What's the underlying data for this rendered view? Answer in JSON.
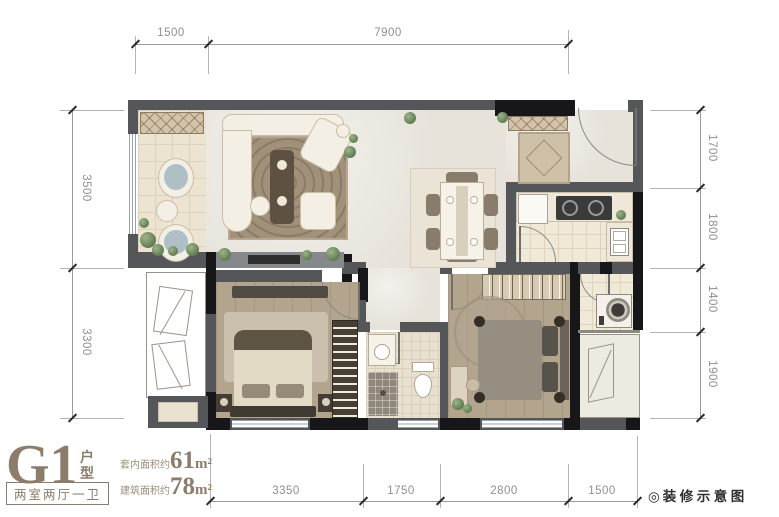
{
  "plan": {
    "title_code": "G1",
    "title_type": "户型",
    "layout_tag": "两室两厅一卫",
    "areas": [
      {
        "label": "套内面积约",
        "value": "61",
        "unit": "m²"
      },
      {
        "label": "建筑面积约",
        "value": "78",
        "unit": "m²"
      }
    ],
    "note_icon": "◎",
    "note_text": "装修示意图"
  },
  "dimensions": {
    "top": [
      "1500",
      "7900"
    ],
    "left": [
      "3500",
      "3300"
    ],
    "right": [
      "1700",
      "1800",
      "1400",
      "1900"
    ],
    "bottom": [
      "3350",
      "1750",
      "2800",
      "1500"
    ]
  },
  "colors": {
    "wall": "#55565a",
    "wall_dark": "#17171a",
    "accent": "#8c7d6b",
    "dimension_text": "#8f8f8f",
    "floor_wood": "#b3a48e",
    "floor_tile": "#ece4d1"
  }
}
